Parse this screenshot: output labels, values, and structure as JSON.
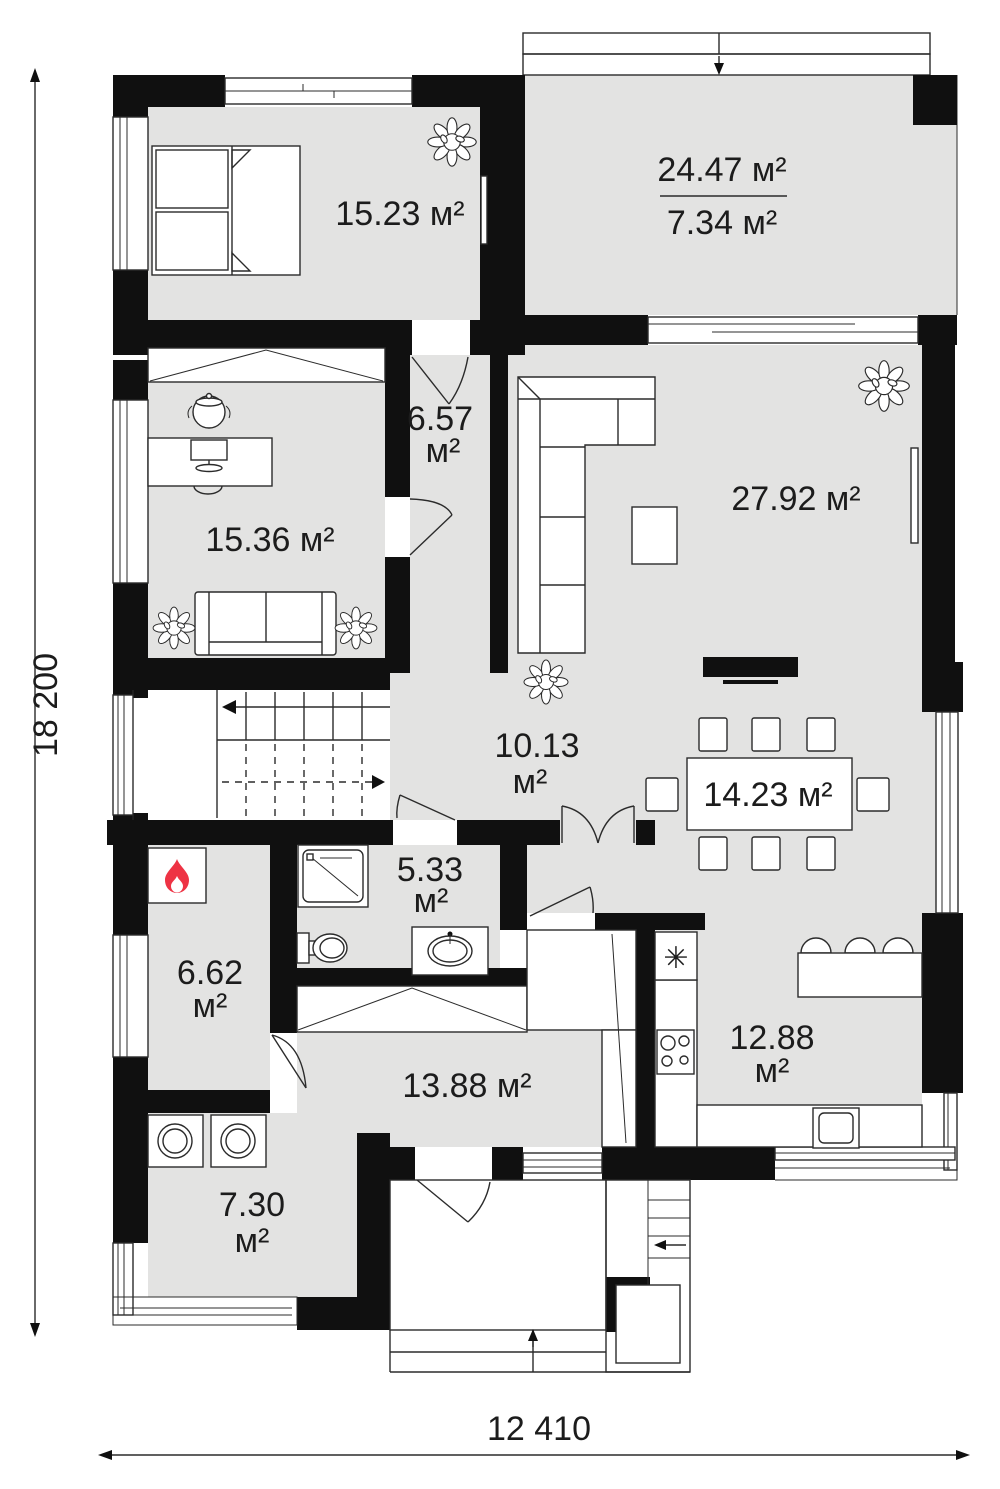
{
  "title": "house-first-floor-plan",
  "colors": {
    "background": "#ffffff",
    "floor": "#e3e3e2",
    "wall": "#101010",
    "line": "#2b2b2b",
    "flame_red": "#ee3344"
  },
  "rooms": {
    "bedroom": {
      "label": "15.23 м²"
    },
    "terrace": {
      "area_total": "24.47 м²",
      "area_lower": "7.34 м²"
    },
    "office": {
      "label": "15.36 м²"
    },
    "hallway": {
      "value": "6.57",
      "unit": "м²"
    },
    "living_room": {
      "label": "27.92 м²"
    },
    "hall": {
      "value": "10.13",
      "unit": "м²"
    },
    "dining": {
      "label": "14.23 м²"
    },
    "bathroom": {
      "value": "5.33",
      "unit": "м²"
    },
    "boiler_room": {
      "value": "6.62",
      "unit": "м²"
    },
    "kitchen": {
      "value": "12.88",
      "unit": "м²"
    },
    "corridor": {
      "label": "13.88 м²"
    },
    "laundry": {
      "value": "7.30",
      "unit": "м²"
    }
  },
  "dimensions": {
    "overall_height": "18 200",
    "overall_width": "12 410"
  },
  "icons": {
    "fridge_symbol": "✳"
  }
}
